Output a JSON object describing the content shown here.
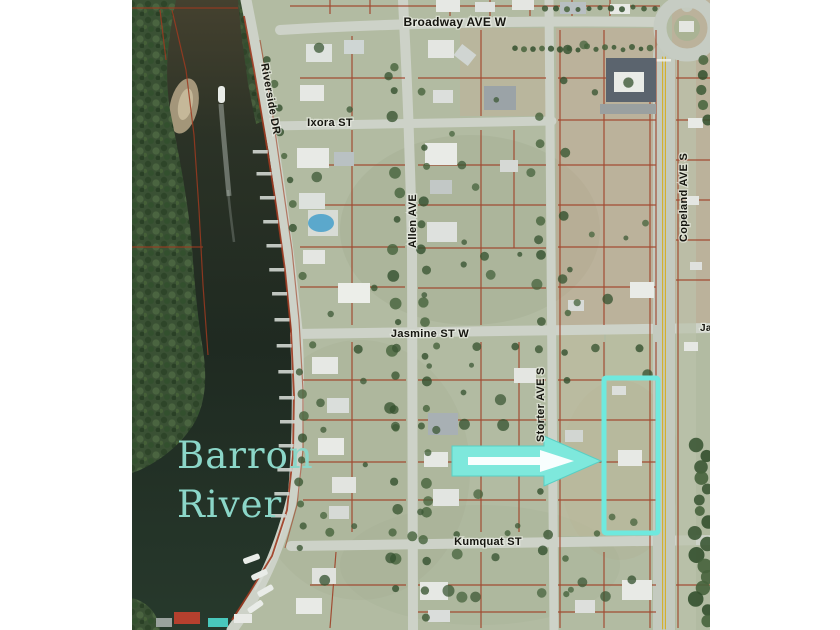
{
  "map": {
    "description": "Aerial parcel map of Everglades City riverfront neighborhood with highlighted lot",
    "river_label": {
      "line1": "Barron",
      "line2": "River"
    },
    "street_labels": {
      "broadway": "Broadway AVE W",
      "ixora": "Ixora ST",
      "jasmine": "Jasmine ST W",
      "kumquat": "Kumquat ST",
      "riverside": "Riverside DR",
      "allen": "Allen AVE",
      "storter": "Storter AVE S",
      "copeland": "Copeland AVE S",
      "jasmine_east_partial": "Ja"
    },
    "colors": {
      "page_background": "#ffffff",
      "land": "#b2bba2",
      "road": "#cdd2c8",
      "water_dark": "#1f2a21",
      "water_brown": "#45412f",
      "forest": "#3a5134",
      "parcel_line": "#9e3a20",
      "highlight_cyan": "#6fe9de",
      "arrow_fill": "#7ee8dc",
      "arrow_inner": "#ffffff",
      "river_text": "#8bd6c8",
      "road_centerline_yellow": "#d4af26"
    },
    "highlight": {
      "kind": "parcel-outline",
      "note": "cyan outlined lot east of Storter AVE S between Jasmine ST W and Kumquat ST"
    }
  }
}
